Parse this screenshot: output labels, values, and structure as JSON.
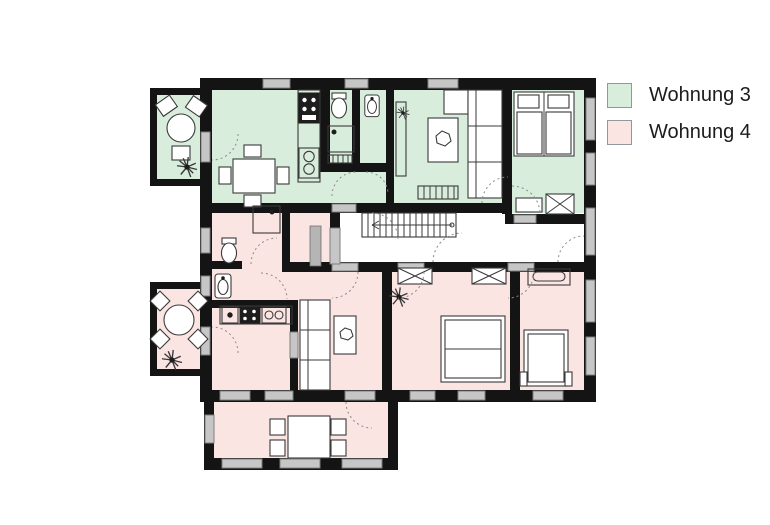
{
  "legend": {
    "items": [
      {
        "name": "wohnung-3",
        "label": "Wohnung 3",
        "color": "#d9eddd"
      },
      {
        "name": "wohnung-4",
        "label": "Wohnung 4",
        "color": "#fbe5e3"
      }
    ]
  },
  "colors": {
    "wall": "#141414",
    "window": "#c6c6c6",
    "window_border": "#7d7d7d",
    "apartment3": "#d9eddd",
    "apartment4": "#fbe5e3",
    "common_area": "#ffffff",
    "furniture_line": "#3a3a3a",
    "door_arc": "#8a8a8a",
    "dark_fixture": "#1d1d1d",
    "background": "#ffffff"
  },
  "floorplan": {
    "elements": [
      {
        "kind": "wall",
        "name": "balcony-upper-outline",
        "x": 150,
        "y": 88,
        "w": 62,
        "h": 98
      },
      {
        "kind": "wall",
        "name": "balcony-lower-outline",
        "x": 150,
        "y": 282,
        "w": 62,
        "h": 94
      },
      {
        "kind": "wall",
        "name": "sunroom-outline",
        "x": 204,
        "y": 390,
        "w": 194,
        "h": 80
      },
      {
        "kind": "wall",
        "name": "main-building-outline",
        "x": 200,
        "y": 78,
        "w": 396,
        "h": 324
      },
      {
        "kind": "a3",
        "name": "balcony-upper-floor",
        "x": 157,
        "y": 95,
        "w": 43,
        "h": 84
      },
      {
        "kind": "a4",
        "name": "balcony-lower-floor",
        "x": 157,
        "y": 289,
        "w": 43,
        "h": 80
      },
      {
        "kind": "a4",
        "name": "sunroom-floor",
        "x": 214,
        "y": 402,
        "w": 174,
        "h": 56
      },
      {
        "kind": "a3",
        "name": "apt3-main-floor",
        "x": 212,
        "y": 90,
        "w": 290,
        "h": 113
      },
      {
        "kind": "a3",
        "name": "apt3-bedroom-floor",
        "x": 512,
        "y": 90,
        "w": 72,
        "h": 124
      },
      {
        "kind": "common",
        "name": "stairwell-floor",
        "x": 340,
        "y": 213,
        "w": 244,
        "h": 55
      },
      {
        "kind": "a4",
        "name": "apt4-bath-floor",
        "x": 212,
        "y": 213,
        "w": 118,
        "h": 95
      },
      {
        "kind": "a4",
        "name": "apt4-main-floor",
        "x": 212,
        "y": 268,
        "w": 372,
        "h": 122
      },
      {
        "kind": "wall",
        "name": "wall-kitchen3-bath3",
        "x": 320,
        "y": 90,
        "w": 10,
        "h": 82
      },
      {
        "kind": "wall",
        "name": "wall-bath3-wc3",
        "x": 352,
        "y": 90,
        "w": 8,
        "h": 75
      },
      {
        "kind": "wall",
        "name": "wall-wc3-living3",
        "x": 386,
        "y": 90,
        "w": 8,
        "h": 113
      },
      {
        "kind": "wall",
        "name": "wall-bath3-vestibule",
        "x": 320,
        "y": 163,
        "w": 74,
        "h": 9
      },
      {
        "kind": "wall",
        "name": "wall-living3-bedroom3",
        "x": 502,
        "y": 90,
        "w": 10,
        "h": 124
      },
      {
        "kind": "wall",
        "name": "wall-apt3-south",
        "x": 200,
        "y": 203,
        "w": 312,
        "h": 10
      },
      {
        "kind": "wall",
        "name": "wall-bedroom3-south",
        "x": 505,
        "y": 214,
        "w": 91,
        "h": 10
      },
      {
        "kind": "wall",
        "name": "wall-bath4-storage",
        "x": 282,
        "y": 213,
        "w": 8,
        "h": 53
      },
      {
        "kind": "wall",
        "name": "wall-storage-hall",
        "x": 330,
        "y": 213,
        "w": 10,
        "h": 55
      },
      {
        "kind": "wall",
        "name": "wall-bath4-stub",
        "x": 212,
        "y": 261,
        "w": 30,
        "h": 8
      },
      {
        "kind": "wall",
        "name": "wall-hall-south",
        "x": 282,
        "y": 262,
        "w": 302,
        "h": 10
      },
      {
        "kind": "wall",
        "name": "wall-kitchen4-north",
        "x": 212,
        "y": 300,
        "w": 86,
        "h": 8
      },
      {
        "kind": "wall",
        "name": "wall-kitchen4-living4",
        "x": 290,
        "y": 300,
        "w": 8,
        "h": 90
      },
      {
        "kind": "wall",
        "name": "wall-living4-bedroom1",
        "x": 382,
        "y": 272,
        "w": 10,
        "h": 118
      },
      {
        "kind": "wall",
        "name": "wall-bedroom1-bedroom2",
        "x": 510,
        "y": 272,
        "w": 10,
        "h": 118
      },
      {
        "kind": "window",
        "name": "window-top-1",
        "x": 263,
        "y": 79,
        "w": 27,
        "h": 9
      },
      {
        "kind": "window",
        "name": "window-top-2",
        "x": 345,
        "y": 79,
        "w": 23,
        "h": 9
      },
      {
        "kind": "window",
        "name": "window-top-3",
        "x": 428,
        "y": 79,
        "w": 30,
        "h": 9
      },
      {
        "kind": "window",
        "name": "window-right-1",
        "x": 586,
        "y": 98,
        "w": 9,
        "h": 42
      },
      {
        "kind": "window",
        "name": "window-right-2",
        "x": 586,
        "y": 153,
        "w": 9,
        "h": 32
      },
      {
        "kind": "window",
        "name": "window-right-3",
        "x": 586,
        "y": 208,
        "w": 9,
        "h": 47
      },
      {
        "kind": "window",
        "name": "window-right-4",
        "x": 586,
        "y": 280,
        "w": 9,
        "h": 42
      },
      {
        "kind": "window",
        "name": "window-right-5",
        "x": 586,
        "y": 337,
        "w": 9,
        "h": 38
      },
      {
        "kind": "window",
        "name": "door-balcony-upper",
        "x": 201,
        "y": 132,
        "w": 9,
        "h": 30
      },
      {
        "kind": "window",
        "name": "window-left-1",
        "x": 201,
        "y": 228,
        "w": 9,
        "h": 25
      },
      {
        "kind": "window",
        "name": "window-left-2",
        "x": 201,
        "y": 276,
        "w": 9,
        "h": 20
      },
      {
        "kind": "window",
        "name": "door-balcony-lower",
        "x": 201,
        "y": 327,
        "w": 9,
        "h": 28
      },
      {
        "kind": "window",
        "name": "window-south-1",
        "x": 220,
        "y": 391,
        "w": 30,
        "h": 9
      },
      {
        "kind": "window",
        "name": "window-south-2",
        "x": 265,
        "y": 391,
        "w": 28,
        "h": 9
      },
      {
        "kind": "window",
        "name": "door-sunroom",
        "x": 345,
        "y": 391,
        "w": 30,
        "h": 9
      },
      {
        "kind": "window",
        "name": "window-south-3",
        "x": 410,
        "y": 391,
        "w": 25,
        "h": 9
      },
      {
        "kind": "window",
        "name": "window-south-4",
        "x": 458,
        "y": 391,
        "w": 27,
        "h": 9
      },
      {
        "kind": "window",
        "name": "window-south-5",
        "x": 533,
        "y": 391,
        "w": 30,
        "h": 9
      },
      {
        "kind": "window",
        "name": "window-sunroom-1",
        "x": 222,
        "y": 459,
        "w": 40,
        "h": 9
      },
      {
        "kind": "window",
        "name": "window-sunroom-2",
        "x": 280,
        "y": 459,
        "w": 40,
        "h": 9
      },
      {
        "kind": "window",
        "name": "window-sunroom-3",
        "x": 342,
        "y": 459,
        "w": 40,
        "h": 9
      },
      {
        "kind": "window",
        "name": "window-sunroom-left",
        "x": 205,
        "y": 415,
        "w": 9,
        "h": 28
      },
      {
        "kind": "window",
        "name": "door-apt3-entry",
        "x": 332,
        "y": 204,
        "w": 24,
        "h": 8
      },
      {
        "kind": "window",
        "name": "door-bedroom3",
        "x": 514,
        "y": 215,
        "w": 22,
        "h": 8
      },
      {
        "kind": "window",
        "name": "door-living4",
        "x": 332,
        "y": 263,
        "w": 26,
        "h": 8
      },
      {
        "kind": "window",
        "name": "door-bedroom1",
        "x": 398,
        "y": 263,
        "w": 26,
        "h": 8
      },
      {
        "kind": "window",
        "name": "door-bedroom2",
        "x": 508,
        "y": 263,
        "w": 26,
        "h": 8
      },
      {
        "kind": "window",
        "name": "door-storage",
        "x": 330,
        "y": 228,
        "w": 10,
        "h": 36
      },
      {
        "kind": "window",
        "name": "door-kitchen4-living4",
        "x": 290,
        "y": 332,
        "w": 8,
        "h": 26
      }
    ]
  }
}
